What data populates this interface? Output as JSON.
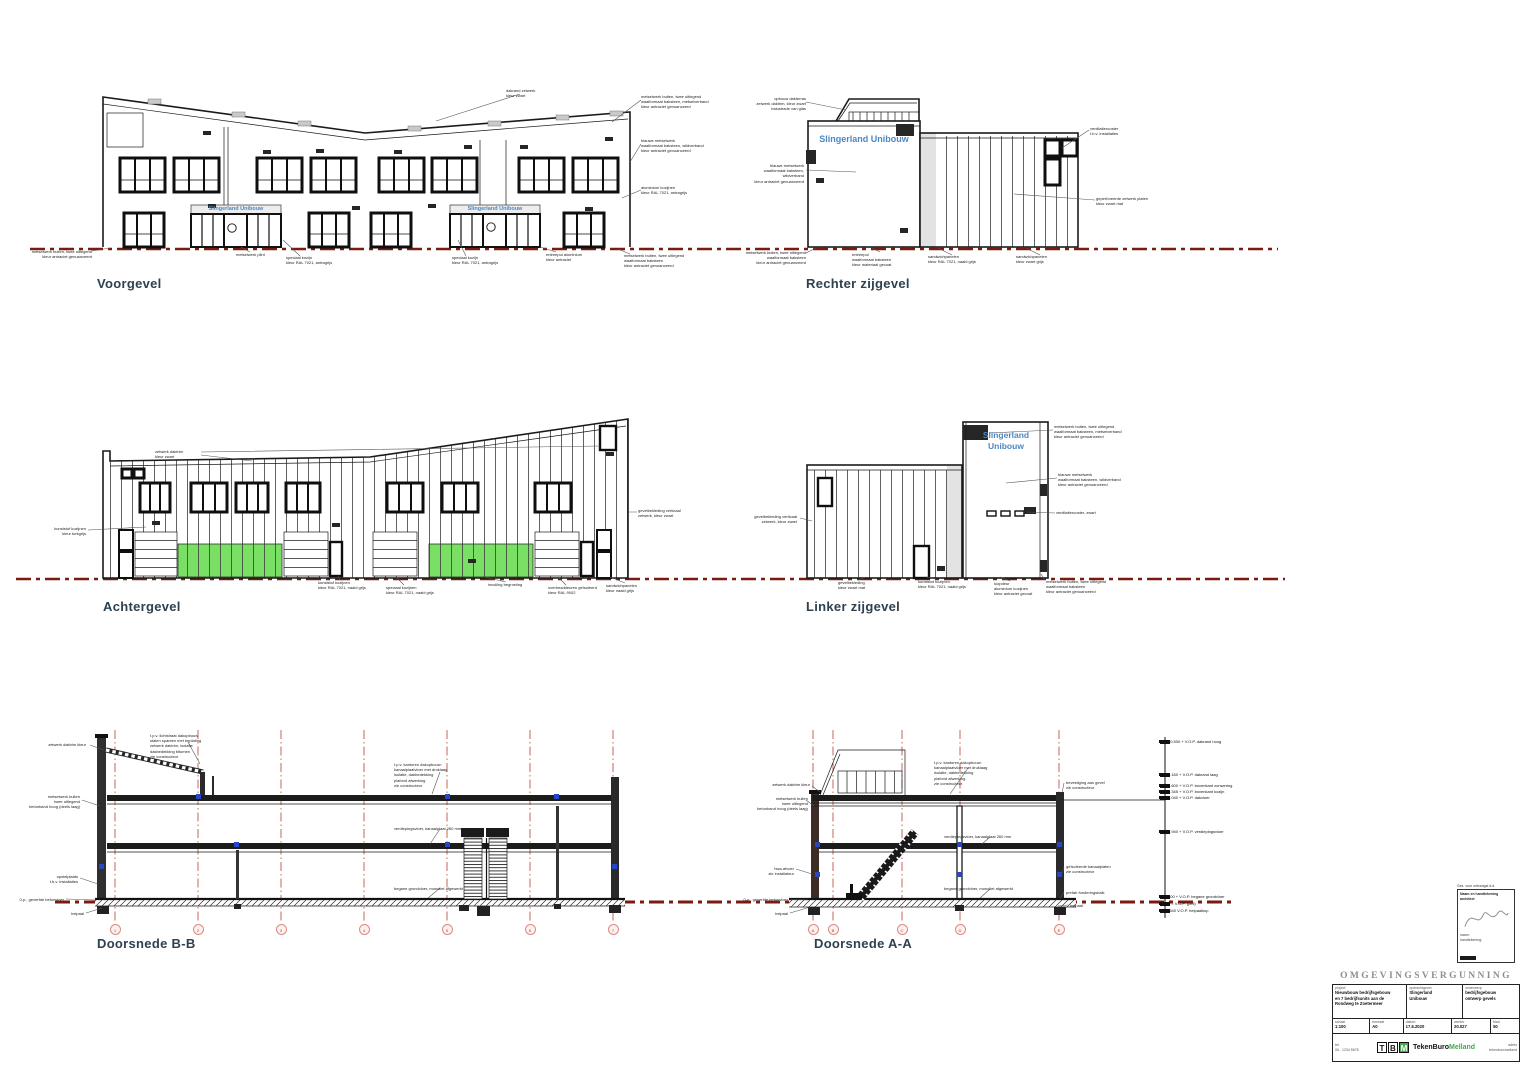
{
  "colors": {
    "sign_blue": "#4b87c2",
    "door_green": "#79df65",
    "ground_red": "#7c1a10",
    "grid_red": "#c0554a",
    "logo_green": "#44a84d"
  },
  "views": {
    "voorgevel": {
      "title": "Voorgevel",
      "sign": "Slingerland Unibouw"
    },
    "rechter_zijgevel": {
      "title": "Rechter zijgevel",
      "sign": "Slingerland Unibouw"
    },
    "achtergevel": {
      "title": "Achtergevel"
    },
    "linker_zijgevel": {
      "title": "Linker zijgevel",
      "sign": "Slingerland\nUnibouw"
    },
    "doorsnede_bb": {
      "title": "Doorsnede B-B"
    },
    "doorsnede_aa": {
      "title": "Doorsnede A-A"
    }
  },
  "annotations": [
    {
      "x": 30,
      "y": 249,
      "w": 62,
      "a": "right",
      "t": "metselwerk buiten, twee uitlegend\nkleur antraciet genuanceerd"
    },
    {
      "x": 506,
      "y": 88,
      "w": 48,
      "a": "left",
      "t": "dakrand zetwerk\nkleur zwart"
    },
    {
      "x": 641,
      "y": 94,
      "w": 74,
      "a": "left",
      "t": "metselwerk buiten, twee uitlegend\nwaalformaat baksteen, metselverband\nkleur antraciet genuanceerd"
    },
    {
      "x": 641,
      "y": 138,
      "w": 74,
      "a": "left",
      "t": "blauwe metselwerk\nwaalformaat baksteen, wildverband\nkleur antraciet genuanceerd"
    },
    {
      "x": 641,
      "y": 185,
      "w": 66,
      "a": "left",
      "t": "aluminium kozijnen\nkleur RAL 7021, antragrijs"
    },
    {
      "x": 236,
      "y": 252,
      "w": 46,
      "a": "left",
      "t": "metselwerk plint"
    },
    {
      "x": 286,
      "y": 255,
      "w": 58,
      "a": "left",
      "t": "speciaal kozijn\nkleur RAL 7021, antragrijs"
    },
    {
      "x": 452,
      "y": 255,
      "w": 58,
      "a": "left",
      "t": "speciaal kozijn\nkleur RAL 7021, antragrijs"
    },
    {
      "x": 546,
      "y": 252,
      "w": 58,
      "a": "left",
      "t": "entreepui aluminium\nkleur antraciet"
    },
    {
      "x": 624,
      "y": 253,
      "w": 76,
      "a": "left",
      "t": "metselwerk buiten, twee uitlegend\nwaalformaat baksteen\nkleur antraciet genuanceerd"
    },
    {
      "x": 742,
      "y": 96,
      "w": 64,
      "a": "right",
      "t": "opbouw dakterras\nzetwerk daktrim, kleur zwart\nbalustrade van glas"
    },
    {
      "x": 742,
      "y": 163,
      "w": 62,
      "a": "right",
      "t": "blauwe metselwerk\nwaalformaat baksteen, wildverband\nkleur antraciet genuanceerd"
    },
    {
      "x": 744,
      "y": 250,
      "w": 62,
      "a": "right",
      "t": "metselwerk buiten, twee uitlegend\nwaalformaat baksteen\nkleur antraciet genuanceerd"
    },
    {
      "x": 852,
      "y": 252,
      "w": 58,
      "a": "left",
      "t": "entreepui\nwaalformaat baksteen\nkleur materiaal gecoat"
    },
    {
      "x": 928,
      "y": 254,
      "w": 62,
      "a": "left",
      "t": "sandwichpanelen\nkleur RAL 7021, naald grijs"
    },
    {
      "x": 1016,
      "y": 254,
      "w": 62,
      "a": "left",
      "t": "sandwichpanelen\nkleur zwart grijs"
    },
    {
      "x": 1090,
      "y": 126,
      "w": 60,
      "a": "left",
      "t": "ventilatierooster\nt.b.v. installaties"
    },
    {
      "x": 1096,
      "y": 196,
      "w": 64,
      "a": "left",
      "t": "geperforeerde zetwerk platen\nkleur zwart mat"
    },
    {
      "x": 155,
      "y": 449,
      "w": 46,
      "a": "left",
      "t": "zetwerk daktrim\nkleur zwart"
    },
    {
      "x": 28,
      "y": 526,
      "w": 58,
      "a": "right",
      "t": "kunststof kozijnen\nkleur turkgrijs"
    },
    {
      "x": 318,
      "y": 580,
      "w": 58,
      "a": "left",
      "t": "kunststof kozijnen\nkleur RAL 7021, naald grijs"
    },
    {
      "x": 386,
      "y": 585,
      "w": 58,
      "a": "left",
      "t": "speciaal kozijnen\nkleur RAL 7021, naald grijs"
    },
    {
      "x": 488,
      "y": 582,
      "w": 52,
      "a": "left",
      "t": "invulling begroeiing"
    },
    {
      "x": 548,
      "y": 585,
      "w": 62,
      "a": "left",
      "t": "overheaddeuren geïsoleerd\nkleur RAL 9002"
    },
    {
      "x": 606,
      "y": 583,
      "w": 60,
      "a": "left",
      "t": "sandwichpanelen\nkleur naald grijs"
    },
    {
      "x": 638,
      "y": 508,
      "w": 64,
      "a": "left",
      "t": "gevelbekleding verticaal\nzetwerk, kleur zwart"
    },
    {
      "x": 735,
      "y": 514,
      "w": 62,
      "a": "right",
      "t": "gevelbekleding verticaal\nzetwerk, kleur zwart"
    },
    {
      "x": 1054,
      "y": 424,
      "w": 70,
      "a": "left",
      "t": "metselwerk buiten, twee uitlegend\nwaalformaat baksteen, metselverband\nkleur antraciet genuanceerd"
    },
    {
      "x": 1058,
      "y": 472,
      "w": 64,
      "a": "left",
      "t": "blauwe metselwerk\nwaalformaat baksteen, wildverband\nkleur antraciet genuanceerd"
    },
    {
      "x": 1056,
      "y": 510,
      "w": 58,
      "a": "left",
      "t": "ventilatierooster, zwart"
    },
    {
      "x": 838,
      "y": 580,
      "w": 56,
      "a": "left",
      "t": "gevelbekleding\nkleur zwart mat"
    },
    {
      "x": 918,
      "y": 579,
      "w": 58,
      "a": "left",
      "t": "kunststof kozijnen\nkleur RAL 7021, naald grijs"
    },
    {
      "x": 994,
      "y": 581,
      "w": 58,
      "a": "left",
      "t": "loopdeur\naluminium kozijnen\nkleur antraciet gecoat"
    },
    {
      "x": 1046,
      "y": 579,
      "w": 68,
      "a": "left",
      "t": "metselwerk buiten, twee uitlegend\nwaalformaat baksteen\nkleur antraciet genuanceerd"
    },
    {
      "x": 150,
      "y": 733,
      "w": 78,
      "a": "left",
      "t": "t.p.v. lichtstraat dakopbouw\nstalen spanten met beplating\nzetwerk daktrim, isolatie\ndakbedekking bitumen\nzie constructeur"
    },
    {
      "x": 26,
      "y": 742,
      "w": 60,
      "a": "right",
      "t": "zetwerk daktrim kleur"
    },
    {
      "x": 14,
      "y": 794,
      "w": 66,
      "a": "right",
      "t": "metselwerk buiten\ntwee uitlegend\nbetonband hoog (deels laag)"
    },
    {
      "x": 24,
      "y": 874,
      "w": 54,
      "a": "right",
      "t": "opstelplaats\nt.b.v. installaties"
    },
    {
      "x": 2,
      "y": 897,
      "w": 62,
      "a": "right",
      "t": "0-p., geverfde betonvloer"
    },
    {
      "x": 46,
      "y": 911,
      "w": 38,
      "a": "right",
      "t": "heipaal"
    },
    {
      "x": 394,
      "y": 762,
      "w": 82,
      "a": "left",
      "t": "t.p.v. kantoren dakopbouw:\nkanaalplaatvloer met druklaag\nisolatie, dakbedekking\nplafond afwerking\nzie constructeur"
    },
    {
      "x": 394,
      "y": 826,
      "w": 86,
      "a": "left",
      "t": "verdiepingsvloer, kanaalplaat 260 mm"
    },
    {
      "x": 394,
      "y": 886,
      "w": 90,
      "a": "left",
      "t": "begane grondvloer, monoliet afgewerkt"
    },
    {
      "x": 756,
      "y": 782,
      "w": 54,
      "a": "right",
      "t": "zetwerk daktrim kleur"
    },
    {
      "x": 744,
      "y": 796,
      "w": 64,
      "a": "right",
      "t": "metselwerk buiten\ntwee uitlegend\nbetonband hoog (deels laag)"
    },
    {
      "x": 742,
      "y": 866,
      "w": 52,
      "a": "right",
      "t": "hwa-afvoer\nzie installateur"
    },
    {
      "x": 726,
      "y": 897,
      "w": 62,
      "a": "right",
      "t": "0-p., geverfde betonvloer"
    },
    {
      "x": 750,
      "y": 911,
      "w": 38,
      "a": "right",
      "t": "heipaal"
    },
    {
      "x": 934,
      "y": 760,
      "w": 84,
      "a": "left",
      "t": "t.p.v. kantoren dakopbouw:\nkanaalplaatvloer met druklaag\nisolatie, dakbedekking\nplafond afwerking\nzie constructeur"
    },
    {
      "x": 944,
      "y": 834,
      "w": 86,
      "a": "left",
      "t": "verdiepingsvloer, kanaalplaat 260 mm"
    },
    {
      "x": 944,
      "y": 886,
      "w": 90,
      "a": "left",
      "t": "begane grondvloer, monoliet afgewerkt"
    },
    {
      "x": 1066,
      "y": 780,
      "w": 56,
      "a": "left",
      "t": "bevestiging aan gevel\nzie constructeur"
    },
    {
      "x": 1066,
      "y": 864,
      "w": 58,
      "a": "left",
      "t": "geïsoleerde kanaalplaten\nzie constructeur"
    },
    {
      "x": 1066,
      "y": 890,
      "w": 56,
      "a": "left",
      "t": "prefab funderingsbalk"
    },
    {
      "x": 1070,
      "y": 903,
      "w": 40,
      "a": "left",
      "t": "heipaal"
    }
  ],
  "grid_bubbles": {
    "bb": {
      "y": 929,
      "items": [
        {
          "x": 115,
          "label": "1"
        },
        {
          "x": 198,
          "label": "2"
        },
        {
          "x": 281,
          "label": "3"
        },
        {
          "x": 364,
          "label": "4"
        },
        {
          "x": 447,
          "label": "5"
        },
        {
          "x": 530,
          "label": "6"
        },
        {
          "x": 613,
          "label": "7"
        }
      ]
    },
    "aa": {
      "y": 929,
      "items": [
        {
          "x": 813,
          "label": "A"
        },
        {
          "x": 833,
          "label": "B"
        },
        {
          "x": 902,
          "label": "C"
        },
        {
          "x": 960,
          "label": "D"
        },
        {
          "x": 1059,
          "label": "E"
        }
      ]
    }
  },
  "levels": {
    "x": 1159,
    "items": [
      {
        "y": 742,
        "label": "10.500 + V.O.P. dakrand hoog"
      },
      {
        "y": 775,
        "label": "9.160 + V.O.P. dakrand laag"
      },
      {
        "y": 786,
        "label": "8.600 + V.O.P. bovenkant zonwering"
      },
      {
        "y": 792,
        "label": "8.345 + V.O.P. bovenkant kozijn"
      },
      {
        "y": 798,
        "label": "8.040 + V.O.P. dakvloer"
      },
      {
        "y": 832,
        "label": "4.940 + V.O.P. verdiepingsvloer"
      },
      {
        "y": 897,
        "label": "400 + V.O.P. begane grondvloer"
      },
      {
        "y": 904,
        "label": "0 = V.O.P. (peil)"
      },
      {
        "y": 911,
        "label": "-640 V.O.P. heipaalkop"
      }
    ]
  },
  "title_block": {
    "header": "OMGEVINGSVERGUNNING",
    "project_label": "project",
    "project": "Nieuwbouw bedrijfsgebouw\nen 7 bedrijfsunits aan de\nRondweg te Zoetermeer",
    "client_label": "opdrachtgever",
    "client": "Slingerland\nUnibouw",
    "subject_label": "onderwerp",
    "subject": "bedrijfsgebouw\nontwerp gevels",
    "scale_label": "schaal",
    "scale": "1:100",
    "format_label": "formaat",
    "format": "A0",
    "date_label": "datum",
    "date": "17.6.2020",
    "worknr_label": "werknr",
    "worknr": "20.027",
    "sheet_label": "blad",
    "sheet": "50",
    "logo_t": "T",
    "logo_b": "B",
    "logo_m": "M",
    "logo_name_1": "TekenBuro",
    "logo_name_2": "Melland",
    "left_note": "tel.\n06 - 1234 5678",
    "right_note": "adres\ntekenburomelland"
  },
  "stamp": {
    "top_label": "Gez. voor ontvangst d.d.",
    "box_title": "Naam en handtekening\narchitect",
    "bottom_note": "naam:\nhandtekening:"
  }
}
